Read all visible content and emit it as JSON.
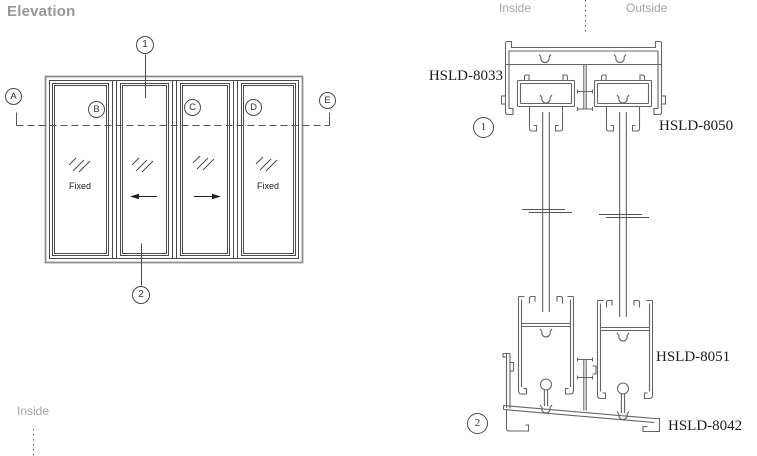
{
  "title": "Elevation",
  "colors": {
    "background": "#ffffff",
    "line_dark": "#4a4a4a",
    "line_profile": "#666666",
    "frame_outer": "#8f8f8f",
    "label_gray": "#a2a5a8",
    "title_gray": "#96989b",
    "label_black": "#1c1c1c"
  },
  "elevation": {
    "grid_markers": [
      {
        "label": "A"
      },
      {
        "label": "B"
      },
      {
        "label": "C"
      },
      {
        "label": "D"
      },
      {
        "label": "E"
      }
    ],
    "section_markers": {
      "top": "1",
      "bottom": "2"
    },
    "panels": [
      {
        "label": "Fixed",
        "type": "fixed"
      },
      {
        "label": "",
        "type": "slides-left"
      },
      {
        "label": "",
        "type": "slides-right"
      },
      {
        "label": "Fixed",
        "type": "fixed"
      }
    ],
    "inside_label": "Inside"
  },
  "section": {
    "inside_label": "Inside",
    "outside_label": "Outside",
    "markers": [
      {
        "label": "1"
      },
      {
        "label": "2"
      }
    ],
    "profiles": [
      {
        "code": "HSLD-8033",
        "position": "head-track"
      },
      {
        "code": "HSLD-8050",
        "position": "top-sash-rail"
      },
      {
        "code": "HSLD-8051",
        "position": "bottom-sash-rail"
      },
      {
        "code": "HSLD-8042",
        "position": "sill-track"
      }
    ]
  }
}
